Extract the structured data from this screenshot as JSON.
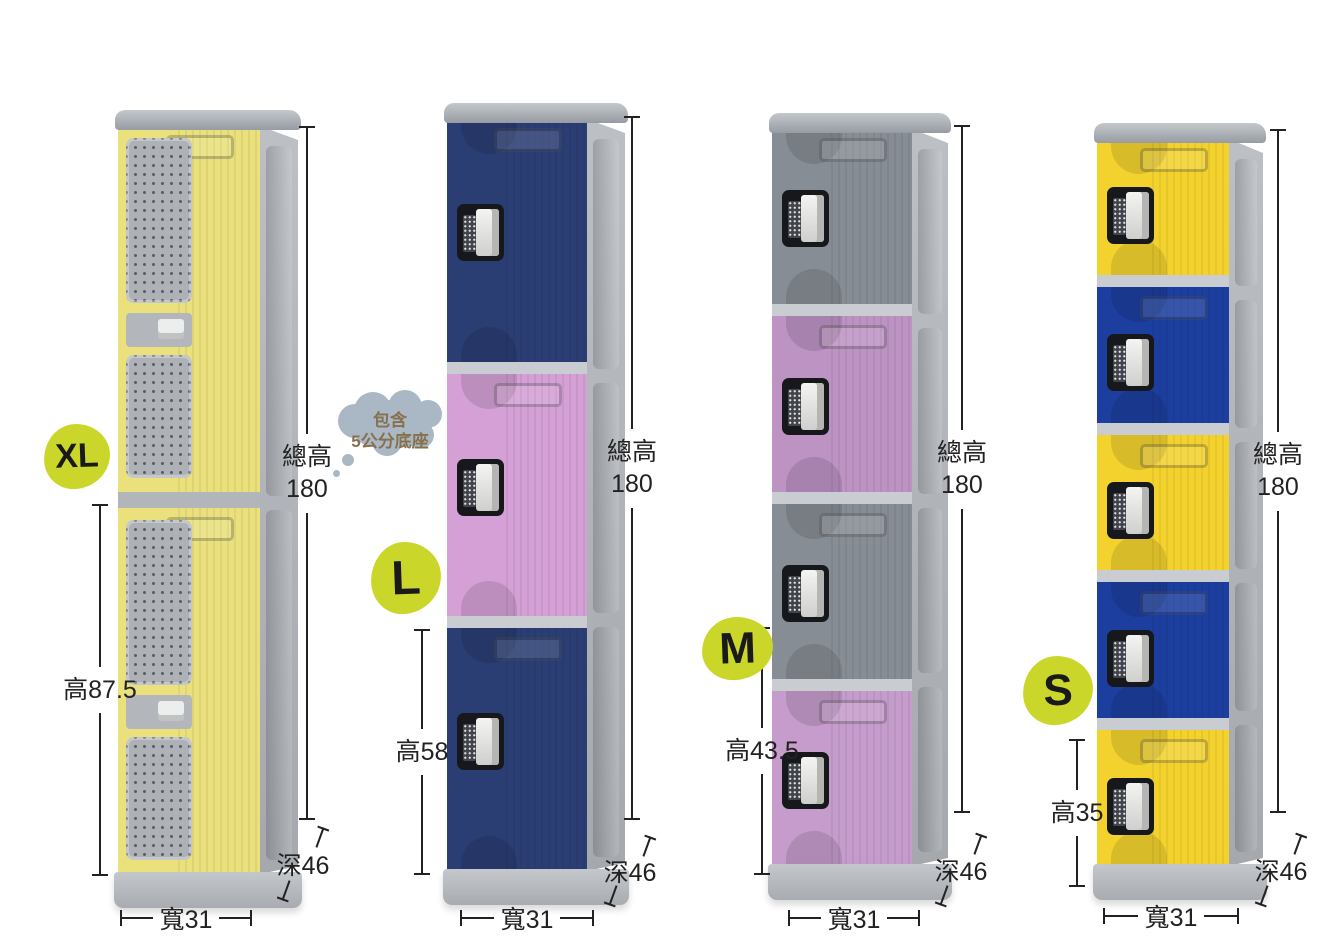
{
  "canvas": {
    "background": "#ffffff"
  },
  "annotation_color": "#222222",
  "badge": {
    "bg": "#cbd62b",
    "text_color": "#1a1a1a"
  },
  "thought_bubble": {
    "lines": [
      "包含",
      "5公分底座"
    ],
    "bg": "#a9b8c4",
    "text_color": "#87704e"
  },
  "lockers": [
    {
      "id": "xl",
      "badge_label": "XL",
      "vented": true,
      "door_colors": [
        "#eae17c",
        "#eae17c"
      ],
      "dimensions": {
        "total_height_label": "總高",
        "total_height_value": "180",
        "door_height_label": "高87.5",
        "depth_label": "深46",
        "width_label": "寬31"
      }
    },
    {
      "id": "l",
      "badge_label": "L",
      "vented": false,
      "door_colors": [
        "#2b3e74",
        "#d4a0d6",
        "#2b3e74"
      ],
      "dimensions": {
        "total_height_label": "總高",
        "total_height_value": "180",
        "door_height_label": "高58",
        "depth_label": "深46",
        "width_label": "寬31"
      }
    },
    {
      "id": "m",
      "badge_label": "M",
      "vented": false,
      "door_colors": [
        "#878d95",
        "#bd93c4",
        "#878d95",
        "#c59ccb"
      ],
      "dimensions": {
        "total_height_label": "總高",
        "total_height_value": "180",
        "door_height_label": "高43.5",
        "depth_label": "深46",
        "width_label": "寬31"
      }
    },
    {
      "id": "s",
      "badge_label": "S",
      "vented": false,
      "door_colors": [
        "#f3d22d",
        "#1c3e9f",
        "#f3d22d",
        "#1c3e9f",
        "#f3d22d"
      ],
      "dimensions": {
        "total_height_label": "總高",
        "total_height_value": "180",
        "door_height_label": "高35",
        "depth_label": "深46",
        "width_label": "寬31"
      }
    }
  ]
}
